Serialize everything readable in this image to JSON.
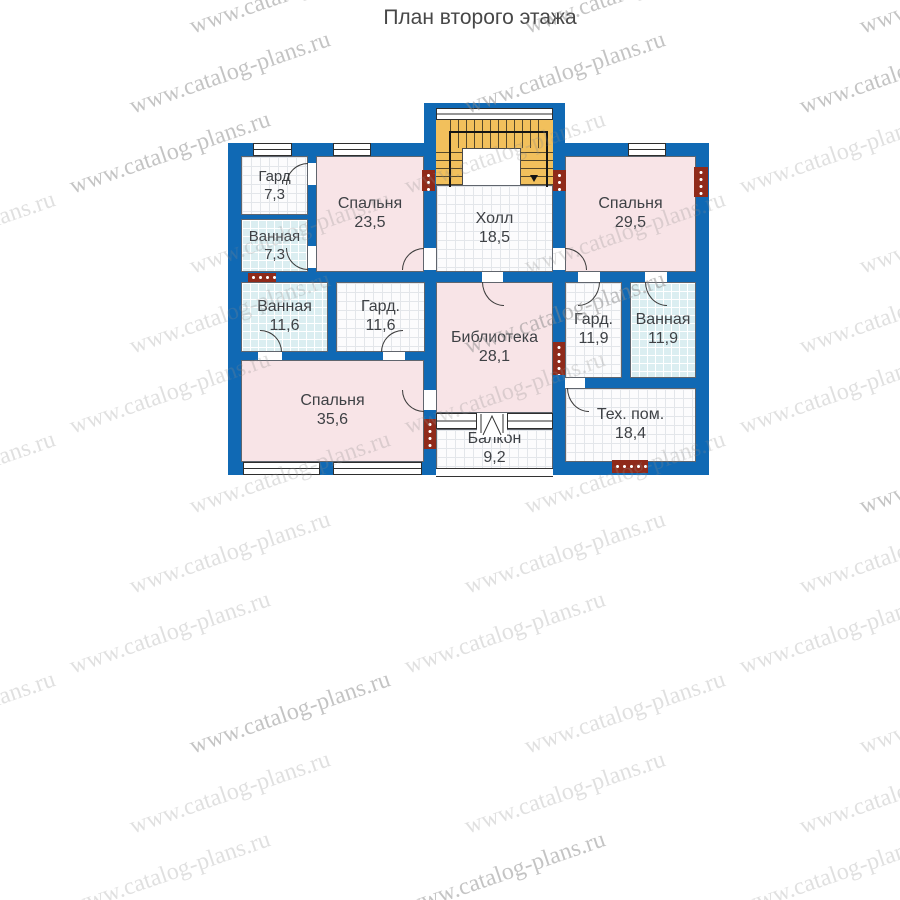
{
  "title": "План второго этажа",
  "watermark": {
    "text": "www.catalog-plans.ru"
  },
  "rooms": [
    {
      "id": "gard-7-3",
      "name": "Гард",
      "area": "7,3"
    },
    {
      "id": "vannaya-7-3",
      "name": "Ванная",
      "area": "7,3"
    },
    {
      "id": "spalnya-23-5",
      "name": "Спальня",
      "area": "23,5"
    },
    {
      "id": "holl",
      "name": "Холл",
      "area": "18,5"
    },
    {
      "id": "spalnya-29-5",
      "name": "Спальня",
      "area": "29,5"
    },
    {
      "id": "vannaya-11-6",
      "name": "Ванная",
      "area": "11,6"
    },
    {
      "id": "gard-11-6",
      "name": "Гард.",
      "area": "11,6"
    },
    {
      "id": "biblioteka",
      "name": "Библиотека",
      "area": "28,1"
    },
    {
      "id": "gard-11-9",
      "name": "Гард.",
      "area": "11,9"
    },
    {
      "id": "vannaya-11-9",
      "name": "Ванная",
      "area": "11,9"
    },
    {
      "id": "spalnya-35-6",
      "name": "Спальня",
      "area": "35,6"
    },
    {
      "id": "balkon",
      "name": "Балкон",
      "area": "9,2"
    },
    {
      "id": "teh-pom",
      "name": "Тех. пом.",
      "area": "18,4"
    }
  ],
  "colors": {
    "wall": "#1069b4",
    "bedroom_floor": "#f8e4e7",
    "bathroom_floor": "#dbeef1",
    "utility_floor": "#fcfcfd",
    "stairs": "#f2c05c",
    "vent_block": "#8f2a1a",
    "label_text": "#3e4145",
    "watermark_gray": "#8a8a8a"
  }
}
